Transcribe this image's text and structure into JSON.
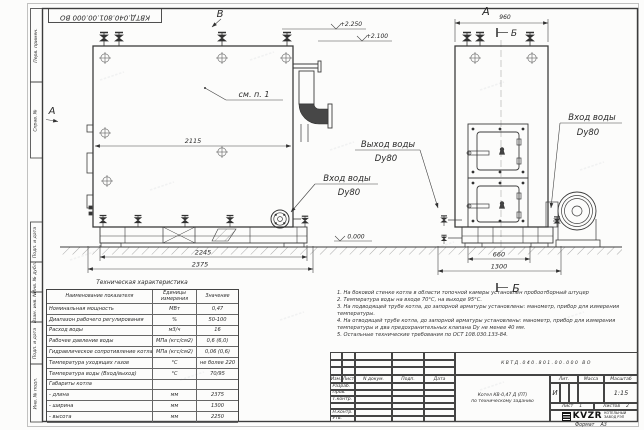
{
  "sheet": {
    "stamp_top": "КВТД.040.801.00.000 ВО",
    "format_label": "Формат",
    "format_value": "А3",
    "margin_boxes": [
      "Перв. примен.",
      "Справ. №",
      "Подп. и дата",
      "Инв. № дубл.",
      "Взам. инв. №",
      "Подп. и дата",
      "Инв. № подл."
    ]
  },
  "drawing": {
    "front_view": {
      "view_arrow_top": "В",
      "view_arrow_left": "А",
      "callout": "см. п. 1",
      "dim_inner_width": "2115",
      "dim_skid_width": "2245",
      "dim_overall_width": "2375",
      "elev_top": "+2.250",
      "elev_mid": "+2.100",
      "elev_zero": "0.000",
      "outlet_line1": "Выход воды",
      "outlet_line2": "Dy80",
      "inlet_line1": "Вход воды",
      "inlet_line2": "Dy80"
    },
    "side_view": {
      "view_label": "А",
      "dim_width": "960",
      "section_label_top": "Б",
      "section_label_bottom": "Б",
      "dim_base_inner": "660",
      "dim_base_overall": "1300",
      "inlet_line1": "Вход воды",
      "inlet_line2": "Dy80"
    }
  },
  "spec_table": {
    "title": "Техническая характеристика",
    "headers": [
      "Наименование показателя",
      "Единицы измерения",
      "Значение"
    ],
    "rows": [
      {
        "name": "Номинальная мощность",
        "unit": "МВт",
        "value": "0,47"
      },
      {
        "name": "Диапазон рабочего регулирования",
        "unit": "%",
        "value": "50-100"
      },
      {
        "name": "Расход воды",
        "unit": "м3/ч",
        "value": "16"
      },
      {
        "name": "Рабочее давление воды",
        "unit": "МПа (кгс/см2)",
        "value": "0,6 (6,0)"
      },
      {
        "name": "Гидравлическое сопротивление котла",
        "unit": "МПа (кгс/см2)",
        "value": "0,06 (0,6)"
      },
      {
        "name": "Температура уходящих газов",
        "unit": "°С",
        "value": "не более 220"
      },
      {
        "name": "Температура воды (Вход/выход)",
        "unit": "°С",
        "value": "70/95"
      },
      {
        "name": "Габариты котла",
        "unit": "",
        "value": ""
      },
      {
        "name": "- длина",
        "unit": "мм",
        "value": "2375"
      },
      {
        "name": "- ширина",
        "unit": "мм",
        "value": "1300"
      },
      {
        "name": "- высота",
        "unit": "мм",
        "value": "2250"
      }
    ]
  },
  "notes": [
    "1. На боковой стенке котла в области топочной камеры установлен пробоотборный штуцер",
    "2. Температура воды на входе 70°С, на выходе 95°С.",
    "3. На подводящей трубе котла, до запорной арматуры установлены: манометр, прибор для измерения температуры.",
    "4. На отводящей трубе котла, до запорной арматуры установлены: манометр, прибор для измерения температуры и два предохранительных клапана Dу не менее 40 мм.",
    "5. Остальные технические требования по ОСТ 108.030.133-84."
  ],
  "title_block": {
    "designation": "КВТД.040.801.00.000 ВО",
    "doc_name_line1": "Котел КВ-0,47 Д (ПТ)",
    "doc_name_line2": "по техническому заданию",
    "col_headers": [
      "Изм.",
      "Лист",
      "N докум.",
      "Подп.",
      "Дата"
    ],
    "sign_rows": [
      "Разраб.",
      "Пров.",
      "Т.контр.",
      "",
      "Н.контр.",
      "Утв."
    ],
    "lit_header": "Лит.",
    "mass_header": "Масса",
    "scale_header": "Масштаб",
    "lit_value": "И",
    "scale_value": "1:15",
    "sheet_label": "Лист",
    "sheet_value": "1",
    "sheets_label": "Листов",
    "sheets_value": "2",
    "company_logo_text": "KVZR",
    "company_name_line1": "КОТЕЛЬНЫЙ",
    "company_name_line2": "ЗАВОД РЭП"
  }
}
